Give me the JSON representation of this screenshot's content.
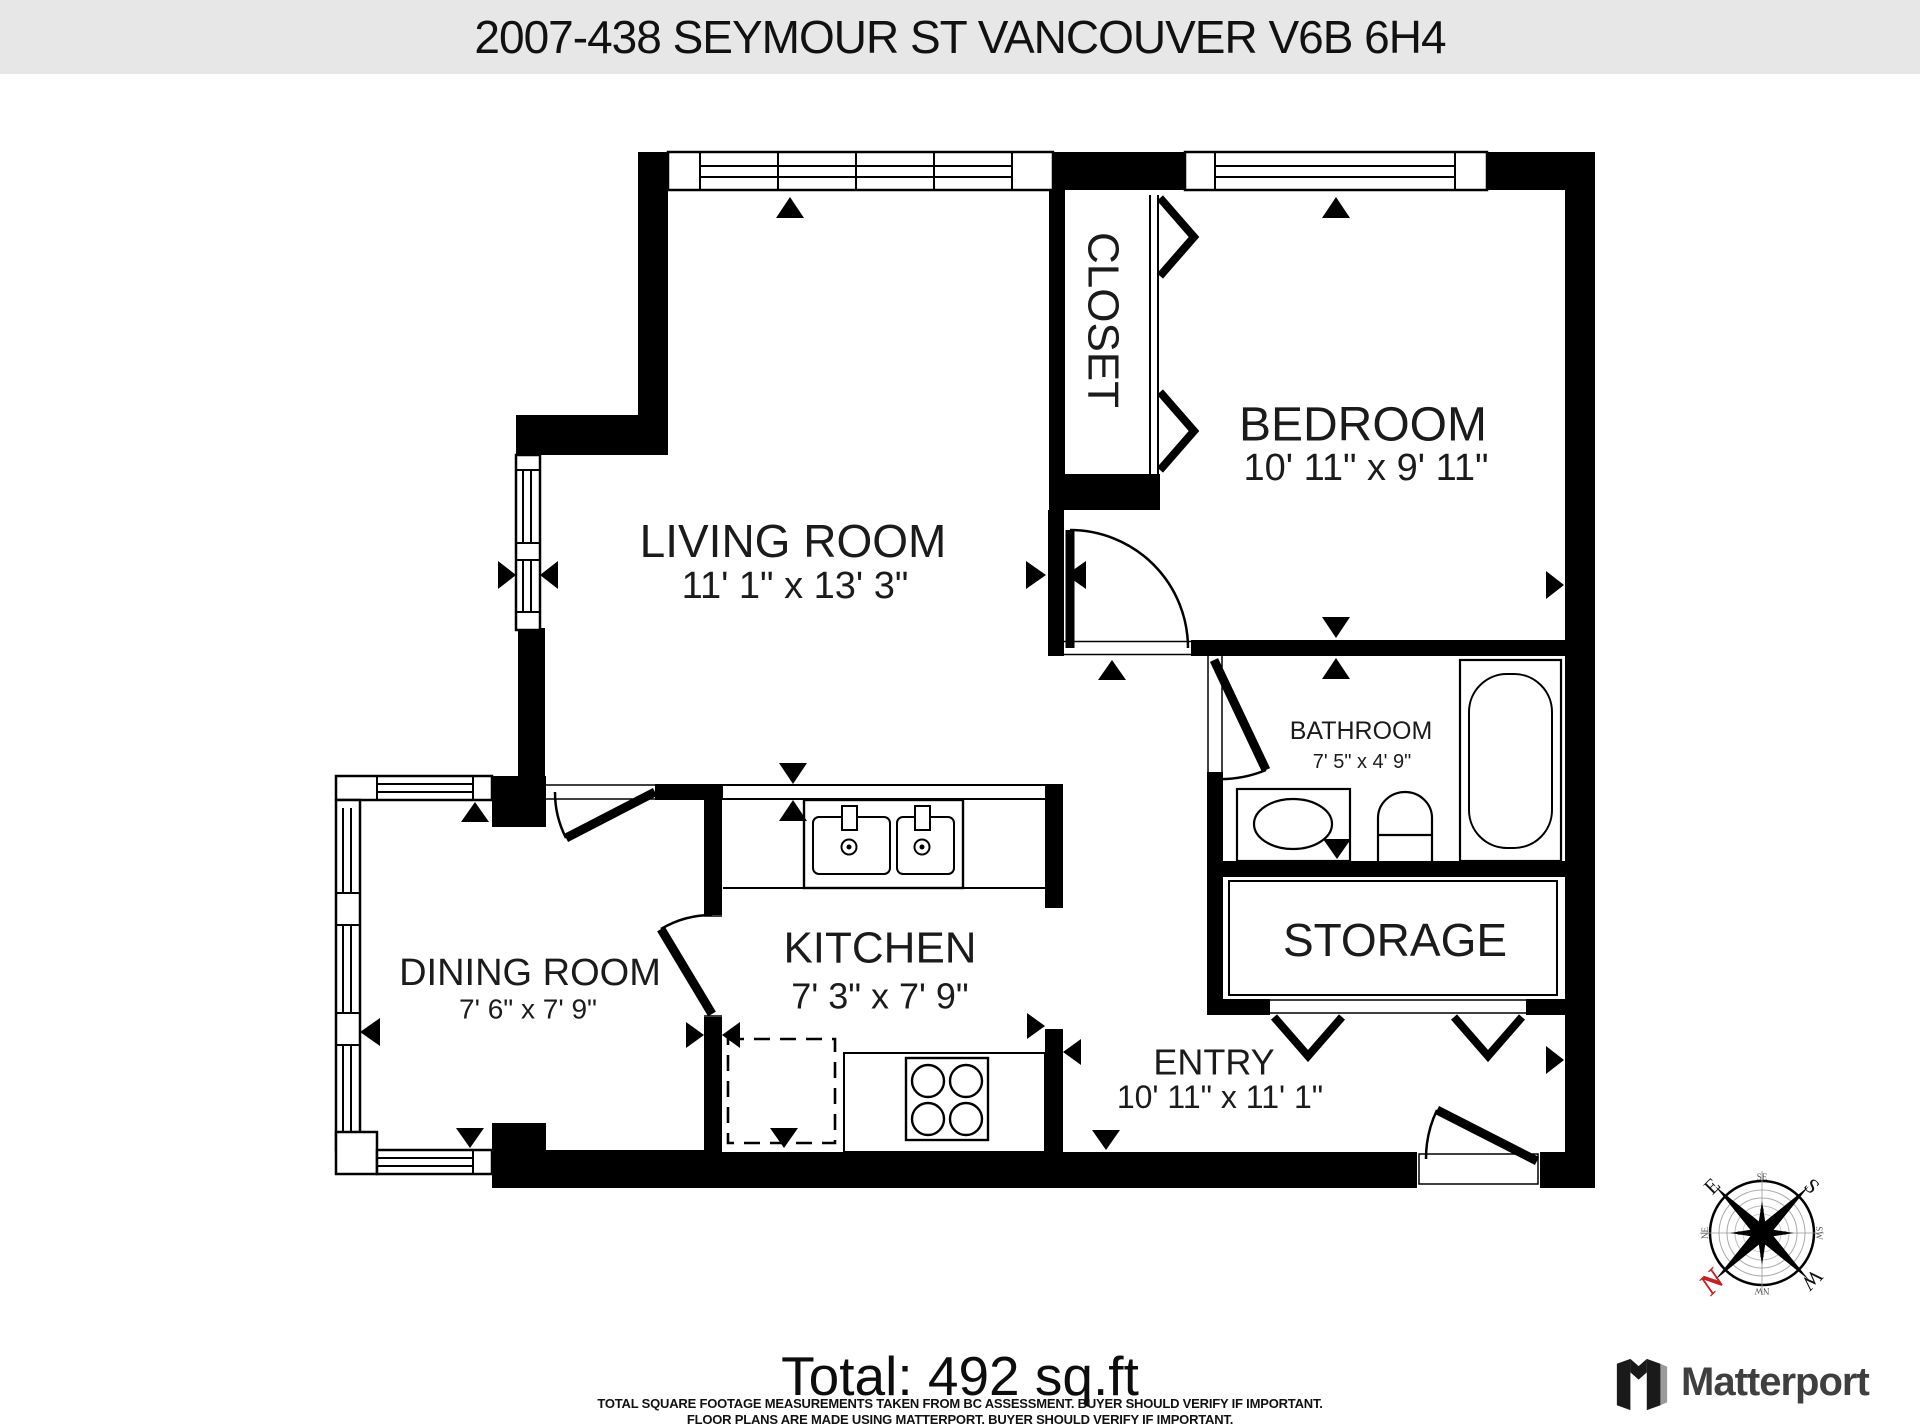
{
  "header": {
    "title": "2007-438 SEYMOUR ST VANCOUVER V6B 6H4"
  },
  "rooms": {
    "living": {
      "name": "LIVING ROOM",
      "dims": "11' 1\" x 13' 3\""
    },
    "bedroom": {
      "name": "BEDROOM",
      "dims": "10' 11\" x 9' 11\""
    },
    "closet": {
      "name": "CLOSET"
    },
    "bathroom": {
      "name": "BATHROOM",
      "dims": "7' 5\" x 4' 9\""
    },
    "dining": {
      "name": "DINING ROOM",
      "dims": "7' 6\" x 7' 9\""
    },
    "kitchen": {
      "name": "KITCHEN",
      "dims": "7' 3\" x 7' 9\""
    },
    "storage": {
      "name": "STORAGE"
    },
    "entry": {
      "name": "ENTRY",
      "dims": "10' 11\" x 11' 1\""
    }
  },
  "footer": {
    "total": "Total: 492 sq.ft",
    "disclaimer_line1": "TOTAL SQUARE FOOTAGE MEASUREMENTS TAKEN FROM BC ASSESSMENT. BUYER SHOULD VERIFY IF IMPORTANT.",
    "disclaimer_line2": "FLOOR PLANS ARE MADE USING MATTERPORT. BUYER SHOULD VERIFY IF IMPORTANT."
  },
  "branding": {
    "logo_text": "Matterport"
  },
  "compass": {
    "cardinal_top_left": "E",
    "cardinal_top_right": "S",
    "cardinal_bottom_right": "W",
    "cardinal_bottom_left": "N",
    "intercardinal_top": "SE",
    "intercardinal_left": "NE",
    "intercardinal_right": "SW",
    "intercardinal_bottom": "NW"
  },
  "colors": {
    "header_bg": "#e7e7e7",
    "plan_line": "#000000",
    "compass_north": "#c22222",
    "logo_text": "#3f3f3f",
    "logo_shade": "#9a9a9a"
  }
}
